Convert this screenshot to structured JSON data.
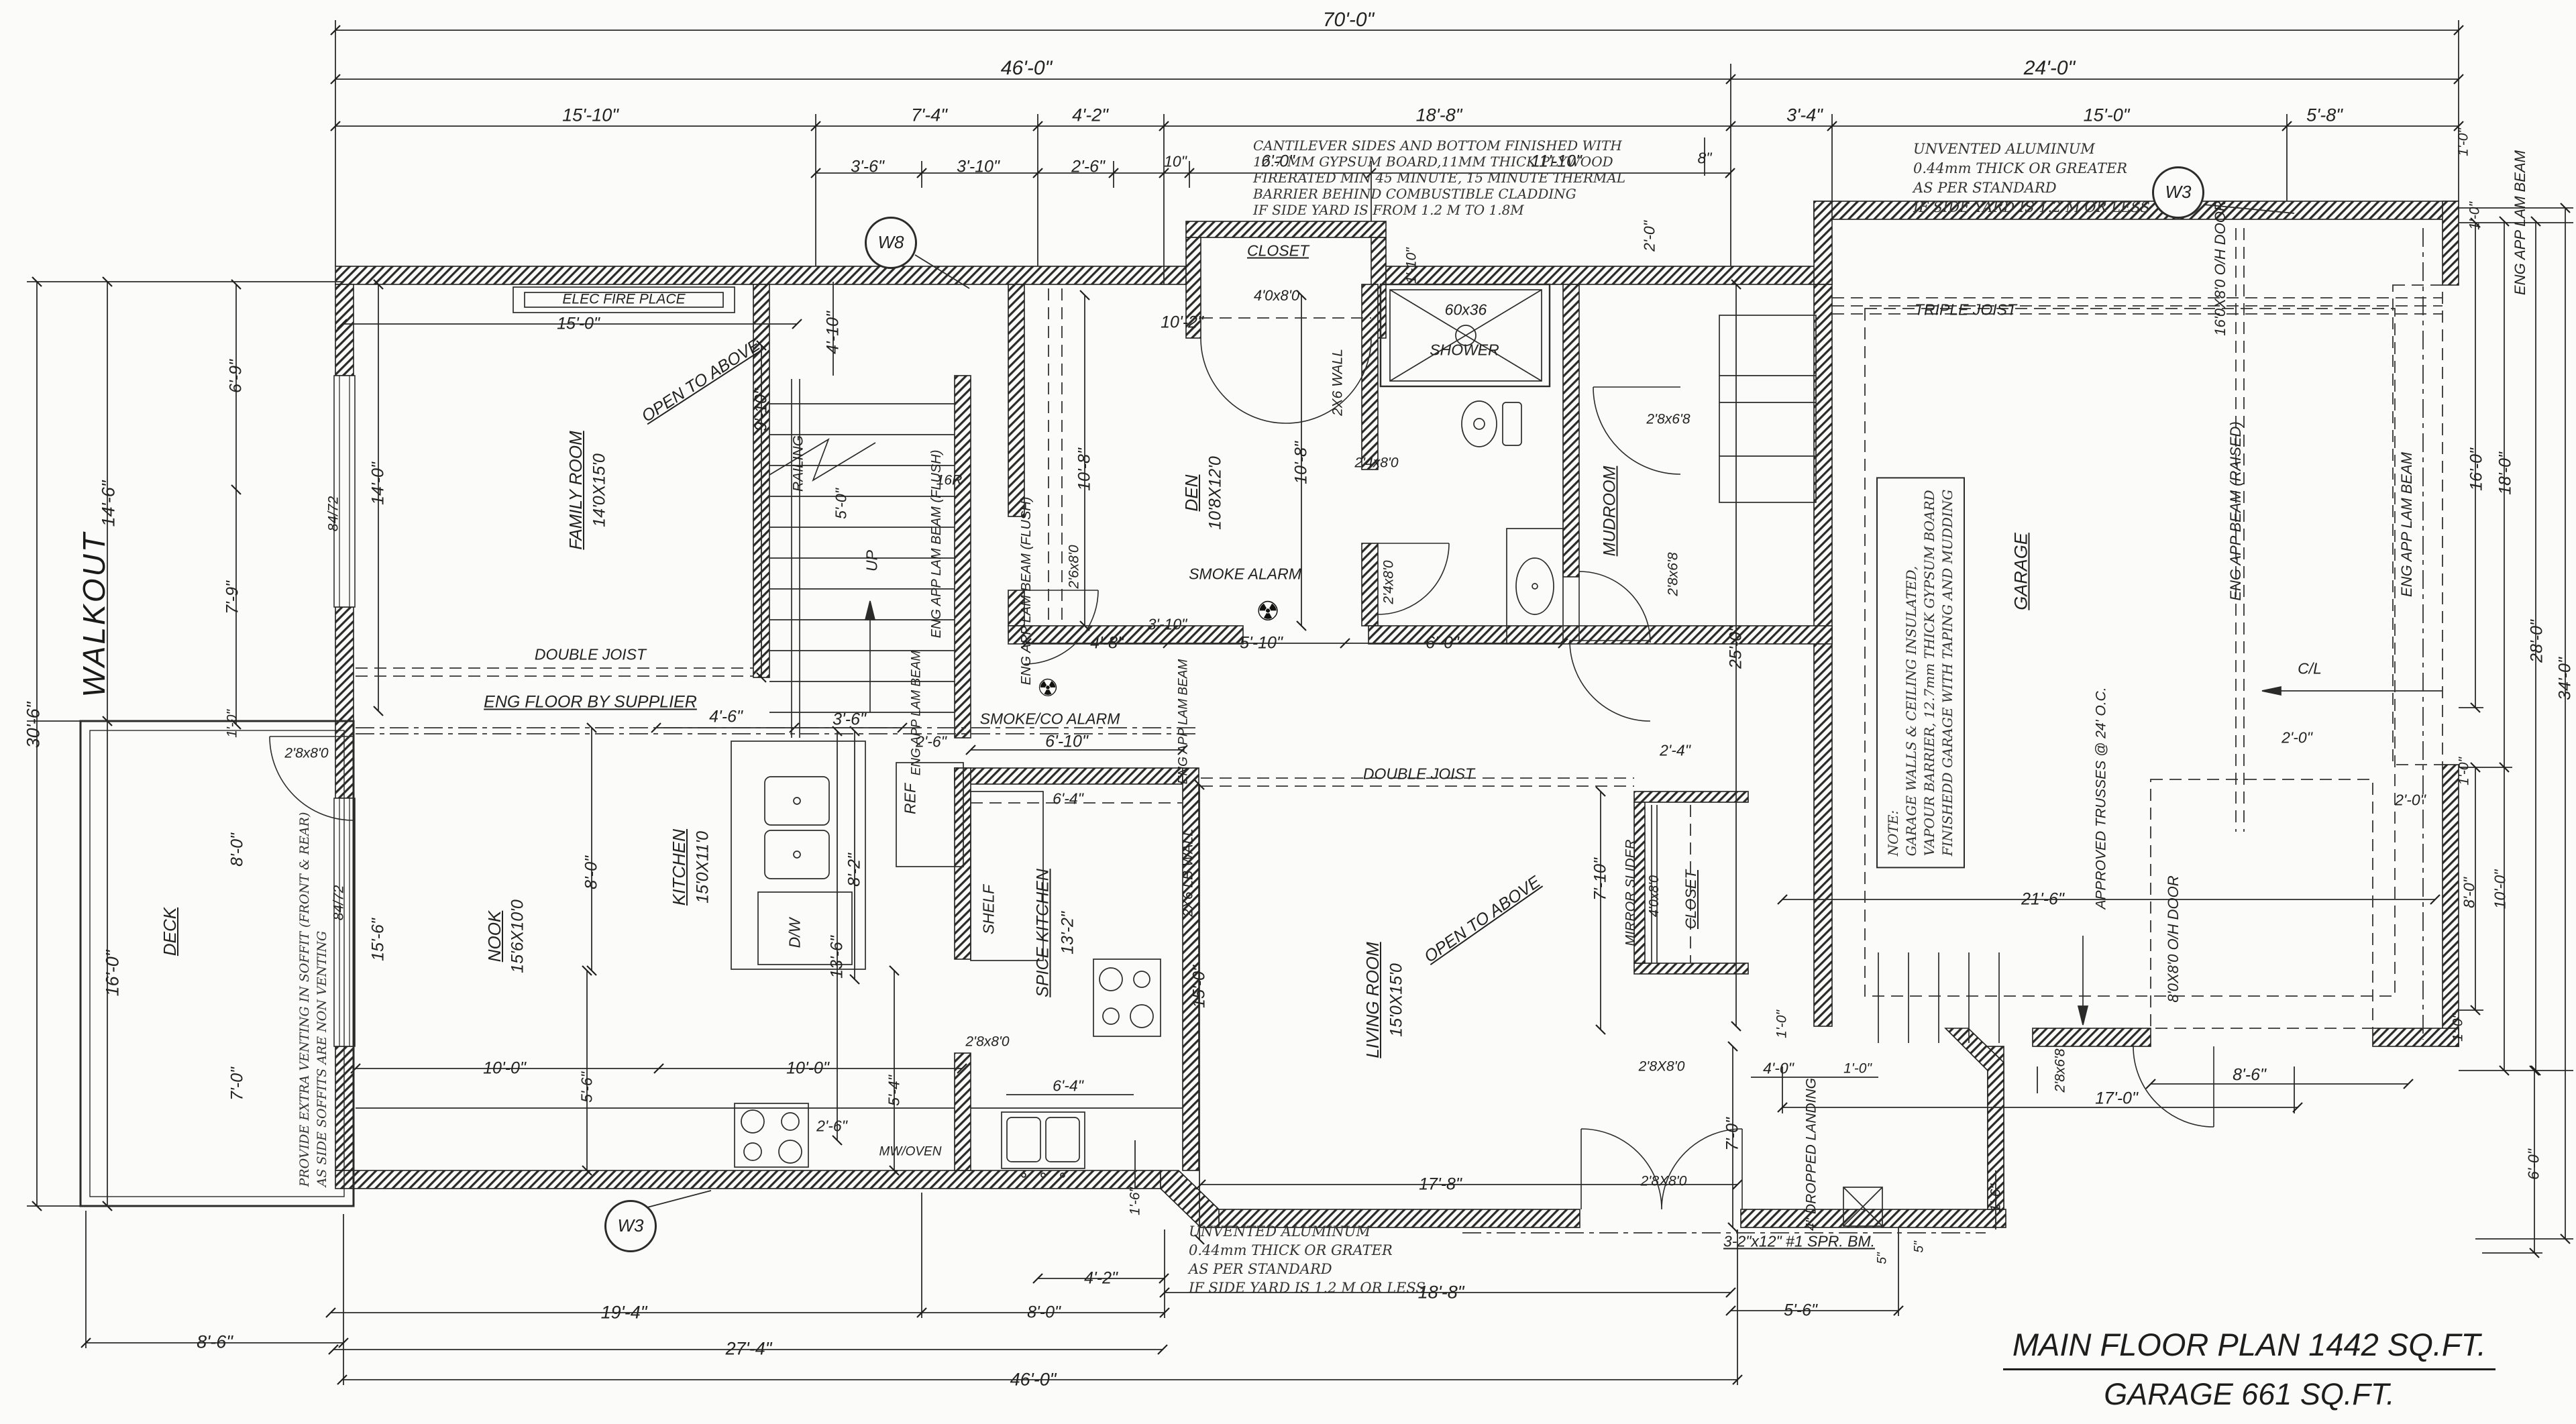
{
  "sheet": {
    "title_line1": "MAIN FLOOR PLAN 1442 SQ.FT.",
    "title_line2": "GARAGE 661 SQ.FT."
  },
  "notes": {
    "cantilever": [
      "CANTILEVER SIDES AND BOTTOM FINISHED WITH",
      "12.7 MM GYPSUM BOARD,11MM THICK PLYWOOD",
      "FIRERATED MIN 45 MINUTE, 15 MINUTE THERMAL",
      "BARRIER BEHIND COMBUSTIBLE CLADDING",
      "IF SIDE YARD IS FROM 1.2 M TO 1.8M"
    ],
    "unvented_top": [
      "UNVENTED ALUMINUM",
      "0.44mm THICK OR GREATER",
      "AS PER STANDARD",
      "IF SIDE YARD IS 1.2 M OR LESS"
    ],
    "unvented_bottom": [
      "UNVENTED ALUMINUM",
      "0.44mm THICK OR GRATER",
      "AS PER STANDARD",
      "IF SIDE YARD IS 1.2 M OR LESS"
    ],
    "soffit": [
      "PROVIDE EXTRA VENTING IN SOFFIT (FRONT & REAR)",
      "AS SIDE SOFFITS ARE NON VENTING"
    ],
    "garage": [
      "NOTE:",
      "GARAGE WALLS & CEILING INSULATED,",
      "VAPOUR BARRIER, 12.7mm THICK GYPSUM BOARD",
      "FINISHEDD GARAGE WITH TAPING AND MUDDING"
    ]
  },
  "labels": [
    "70'-0\"",
    "46'-0\"",
    "24'-0\"",
    "15'-10\"",
    "7'-4\"",
    "4'-2\"",
    "18'-8\"",
    "3'-4\"",
    "15'-0\"",
    "5'-8\"",
    "3'-6\"",
    "3'-10\"",
    "2'-6\"",
    "10\"",
    "6'-0\"",
    "11'-10\"",
    "8\"",
    "2'-0\"",
    "1'-10\"",
    "W8",
    "W3",
    "W3",
    "TRIPLE JOIST",
    "CLOSET",
    "4'0x8'0",
    "10'-2\"",
    "60x36",
    "SHOWER",
    "2X6 WALL",
    "DEN",
    "10'8X12'0",
    "10'-8\"",
    "10'-8\"",
    "2'6x8'0",
    "2'4x8'0",
    "2'4x8'0",
    "SMOKE ALARM",
    "☢",
    "SMOKE/CO ALARM",
    "☢",
    "MUDROOM",
    "2'8x6'8",
    "2'8x6'8",
    "25'-0\"",
    "GARAGE",
    "APPROVED TRUSSES @ 24' O.C.",
    "ENG APP BEAM (RAISED)",
    "16'0X8'0 O/H DOOR",
    "ENG APP LAM BEAM",
    "ENG APP LAM BEAM",
    "C/L",
    "2'-0\"",
    "2'-0\"",
    "21'-6\"",
    "8'0X8'0 O/H DOOR",
    "8'-6\"",
    "17'-0\"",
    "2'8x6'8",
    "1'-0\"",
    "1'-0\"",
    "16'-0\"",
    "18'-0\"",
    "28'-0\"",
    "34'-0\"",
    "1'-0\"",
    "8'-0\"",
    "10'-0\"",
    "1'-0\"",
    "6'-0\"",
    "ELEC FIRE PLACE",
    "15'-0\"",
    "FAMILY ROOM",
    "14'0X15'0",
    "OPEN TO ABOVE",
    "9'-10\"",
    "4'-10\"",
    "RAILING",
    "5'-0\"",
    "16R",
    "UP",
    "14'-0\"",
    "6'-9\"",
    "7'-9\"",
    "84/72",
    "84/72",
    "DOUBLE JOIST",
    "ENG FLOOR BY SUPPLIER",
    "ENG APP LAM BEAM (FLUSH)",
    "ENG APP LAM BEAM (FLUSH)",
    "ENG APP LAM BEAM",
    "ENG APP LAM BEAM",
    "3'-10\"",
    "4'-8\"",
    "5'-10\"",
    "6'-0\"",
    "4'-6\"",
    "3'-6\"",
    "2'-6\"",
    "6'-10\"",
    "NOOK",
    "15'6X10'0",
    "8'-0\"",
    "KITCHEN",
    "15'0X11'0",
    "8'-2\"",
    "13'-6\"",
    "REF",
    "D/W",
    "15'-6\"",
    "SHELF",
    "SPICE KITCHEN",
    "13'-2\"",
    "6'-4\"",
    "6'-4\"",
    "2'8x8'0",
    "MW/OVEN",
    "2X6 LB WALL",
    "15'-0\"",
    "2'-6\"",
    "5'-6\"",
    "5'-4\"",
    "10'-0\"",
    "10'-0\"",
    "DOUBLE JOIST",
    "LIVING ROOM",
    "15'0X15'0",
    "OPEN TO ABOVE",
    "2'-4\"",
    "7'-10\"",
    "MIRROR SLIDER",
    "4'0x8'0",
    "CLOSET",
    "17'-8\"",
    "2'8X8'0",
    "2'8X8'0",
    "7'-0\"",
    "4'-0\"",
    "1'-0\"",
    "1'-0\"",
    "4\" DROPPED LANDING",
    "3-2\"x12\" #1 SPR. BM.",
    "5\"",
    "5\"",
    "1'-6\"",
    "1'-6\"",
    "WALKOUT",
    "DECK",
    "2'8x8'0",
    "8'-0\"",
    "7'-0\"",
    "1'-0\"",
    "14'-6\"",
    "30'-6\"",
    "16'-0\"",
    "8'-6\"",
    "19'-4\"",
    "27'-4\"",
    "46'-0\"",
    "8'-0\"",
    "4'-2\"",
    "18'-8\"",
    "5'-6\""
  ]
}
